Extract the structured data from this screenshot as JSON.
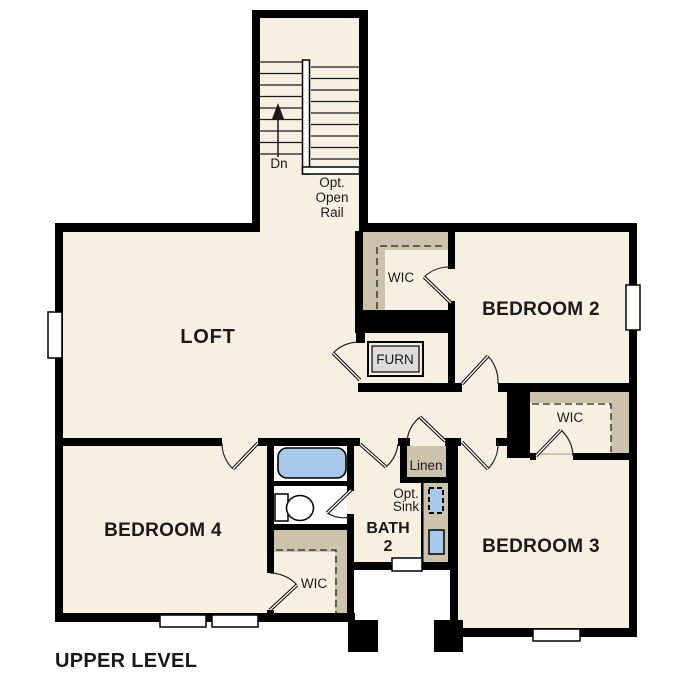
{
  "plan": {
    "title": "UPPER LEVEL",
    "rooms": {
      "loft": {
        "label": "LOFT"
      },
      "bedroom2": {
        "label": "BEDROOM 2"
      },
      "bedroom3": {
        "label": "BEDROOM 3"
      },
      "bedroom4": {
        "label": "BEDROOM 4"
      },
      "bath2": {
        "label_line1": "BATH",
        "label_line2": "2"
      },
      "wic_bedroom2": {
        "label": "WIC"
      },
      "wic_bedroom3": {
        "label": "WIC"
      },
      "wic_bedroom4": {
        "label": "WIC"
      },
      "linen": {
        "label": "Linen"
      },
      "furnace": {
        "label": "FURN"
      }
    },
    "stairs": {
      "direction_label": "Dn",
      "note_line1": "Opt.",
      "note_line2": "Open",
      "note_line3": "Rail"
    },
    "bath": {
      "opt_sink_line1": "Opt.",
      "opt_sink_line2": "Sink"
    },
    "colors": {
      "floor": "#f6efe2",
      "wall": "#000000",
      "closet_shelving": "#cdc2ac",
      "fixture_blue": "#a9c8e9",
      "furnace_fill": "#dcdcdc",
      "outside": "#ffffff",
      "text": "#1a1a1a"
    }
  }
}
